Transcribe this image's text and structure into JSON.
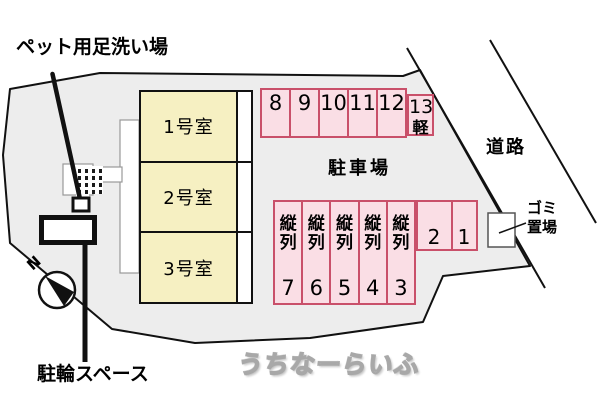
{
  "annotations": {
    "pet_wash": "ペット用足洗い場",
    "bicycle": "駐輪スペース",
    "road": "道路",
    "garbage": [
      "ゴミ",
      "置場"
    ],
    "north": "N"
  },
  "building": {
    "rooms": [
      {
        "label": "1号室"
      },
      {
        "label": "2号室"
      },
      {
        "label": "3号室"
      }
    ]
  },
  "parking": {
    "area_label": "駐車場",
    "top_row": [
      "8",
      "9",
      "10",
      "11",
      "12"
    ],
    "kei": {
      "number": "13",
      "type": "軽"
    },
    "tandem": [
      {
        "type": "縦列",
        "number": "7"
      },
      {
        "type": "縦列",
        "number": "6"
      },
      {
        "type": "縦列",
        "number": "5"
      },
      {
        "type": "縦列",
        "number": "4"
      },
      {
        "type": "縦列",
        "number": "3"
      }
    ],
    "front": [
      "2",
      "1"
    ]
  },
  "watermark": "うちなーらいふ",
  "colors": {
    "site_fill": "#ededed",
    "outline": "#111111",
    "room_fill": "#f6f0c2",
    "parking_fill": "#fadee5",
    "parking_border": "#c9506a"
  }
}
